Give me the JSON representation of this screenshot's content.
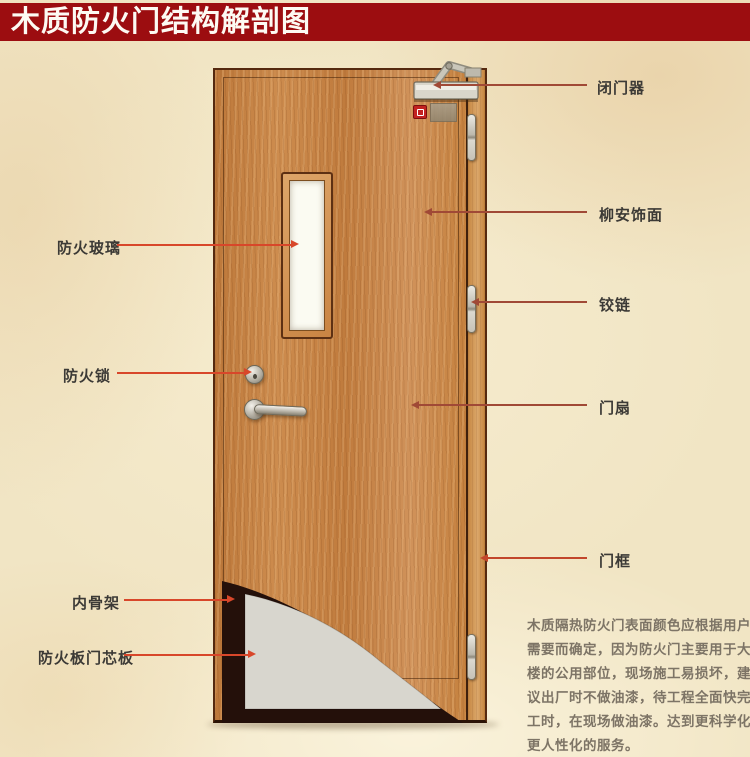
{
  "header": {
    "title": "木质防火门结构解剖图",
    "banner_color": "#9c0d10"
  },
  "callouts": {
    "right": [
      {
        "id": "door-closer",
        "label": "闭门器"
      },
      {
        "id": "lauan-veneer",
        "label": "柳安饰面"
      },
      {
        "id": "hinge",
        "label": "铰链"
      },
      {
        "id": "door-leaf",
        "label": "门扇"
      },
      {
        "id": "door-frame",
        "label": "门框"
      }
    ],
    "left": [
      {
        "id": "fire-glass",
        "label": "防火玻璃"
      },
      {
        "id": "fire-lock",
        "label": "防火锁"
      },
      {
        "id": "inner-skeleton",
        "label": "内骨架"
      },
      {
        "id": "fire-board-core",
        "label": "防火板门芯板"
      }
    ]
  },
  "description": {
    "lines": [
      "木质隔热防火门表面颜色应根据用户",
      "需要而确定，因为防火门主要用于大",
      "楼的公用部位，现场施工易损坏，建",
      "议出厂时不做油漆，待工程全面快完",
      "工时，在现场做油漆。达到更科学化",
      "更人性化的服务。"
    ]
  },
  "door_components": [
    "door-closer-icon",
    "door-closer-arm-icon",
    "fire-sign-icon",
    "seal-patch",
    "fire-glass-window",
    "deadbolt-lock-icon",
    "lever-handle-icon",
    "hinge-top-icon",
    "hinge-middle-icon",
    "hinge-bottom-icon",
    "inner-skeleton-cutaway",
    "fire-board-core-panel",
    "door-leaf-panel",
    "door-frame-strip"
  ],
  "colors": {
    "background": "#f1e5c4",
    "banner": "#9c0d10",
    "title_text": "#fdfaf3",
    "wood_leaf": "#c5813e",
    "wood_frame": "#dba76a",
    "callout_line_right": "#a04936",
    "callout_line_left": "#d8472a",
    "label_text": "#3c3a36",
    "description_text": "#7d7466",
    "glass": "#fbfbf2",
    "core_gray": "#d8d6ce",
    "skeleton_dark": "#24100a",
    "fire_sign_red": "#c32220"
  }
}
